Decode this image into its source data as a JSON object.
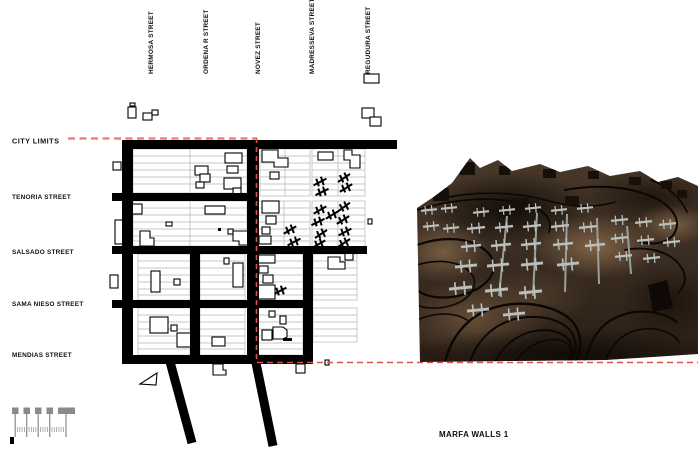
{
  "plan": {
    "city_limits_label": "CITY LIMITS",
    "vertical_streets": [
      "HERMOSA STREET",
      "ORDENA R STREET",
      "NOVEZ STREET",
      "MADRESSEVA STREET",
      "REGUDURA STREET"
    ],
    "horizontal_streets": [
      "TENORIA STREET",
      "SALSADO STREET",
      "SAMA NIESO STREET",
      "MENDIAS STREET"
    ]
  },
  "render": {
    "caption": "MARFA WALLS 1"
  },
  "colors": {
    "accent_red": "#e8262c",
    "dash_red": "#ef7673",
    "dash_red_dark": "#d85250",
    "street_black": "#000000",
    "grid_gray": "#b5b5b5",
    "scale_gray": "#8a8a8a",
    "terrain_brown": "#433325",
    "wall_gray": "#b9bfbc"
  }
}
